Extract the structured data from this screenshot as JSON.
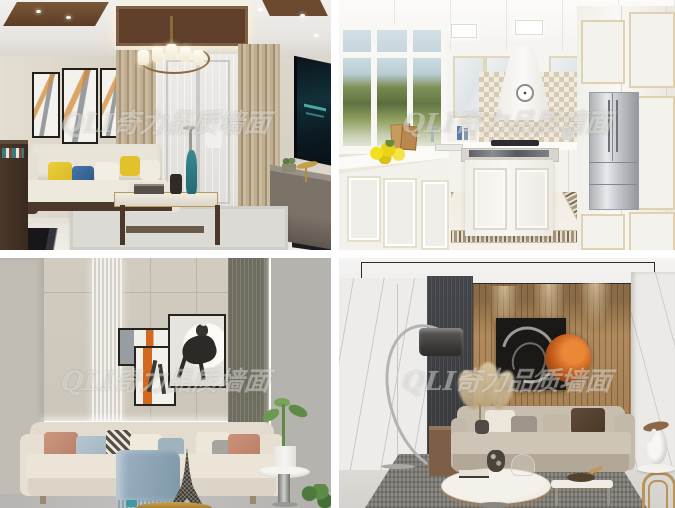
{
  "watermark": {
    "text": "QLI奇力品质墙面",
    "color": "#ffffff",
    "opacity": 0.38,
    "placement": "centered on each photo, italic"
  },
  "gallery": {
    "layout": {
      "rows": 2,
      "cols": 2,
      "gap_px": 8,
      "canvas_px": "675x508"
    },
    "images": [
      {
        "alt": "New Chinese style living room: coffered wood ceiling with brass chandelier, triptych abstract wall art, sheer balcony curtains, white sofa with yellow and blue pillows, marble coffee table, wall-mounted TV and console"
      },
      {
        "alt": "White European style kitchen: recessed ceiling light panels, garden windows, mosaic checker backsplash, chimney range hood with clock, stainless refrigerator, centre island, mosaic tile floor border, lemons on the counter"
      },
      {
        "alt": "Beige living room: fluted wall panels with LED light strips, overlapping equestrian artwork, cream sofa with pink, blue and patterned pillows, blue throw blanket, Eiffel tower ornament, round side table with green plant"
      },
      {
        "alt": "Modern living room: wood slat feature wall with spotlights, black abstract canvas with copper disc, chrome arc floor lamp, greige sofa with pampas grass, round marble coffee tables, grey rug, white bird sculpture on arched side table"
      }
    ]
  },
  "palette": {
    "gap_white": "#ffffff",
    "t1_wall_beige": "#d7d0c5",
    "t1_coffer_wood": "#5f3f29",
    "t1_pillow_yellow": "#e3c42e",
    "t1_pillow_blue": "#3f6da5",
    "t1_tv_teal": "#123038",
    "t2_cabinet_white": "#f5f3ef",
    "t2_backsplash_tan": "#d7cab2",
    "t2_lawn_green": "#7d9055",
    "t2_lemon_yellow": "#e8d21a",
    "t2_steel": "#c2c6c9",
    "t3_wall_greige": "#cfc9bd",
    "t3_olive_panel": "#6f6d5f",
    "t3_art_orange": "#d2691e",
    "t3_pillow_rose": "#c08a74",
    "t3_throw_blue": "#93aaba",
    "t4_wood_wall": "#a8855c",
    "t4_fluted_dark": "#3b3d3f",
    "t4_copper_disc": "#c05a1a",
    "t4_sofa_greige": "#c9c0b1",
    "t4_rug_grey": "#8f8c86"
  }
}
